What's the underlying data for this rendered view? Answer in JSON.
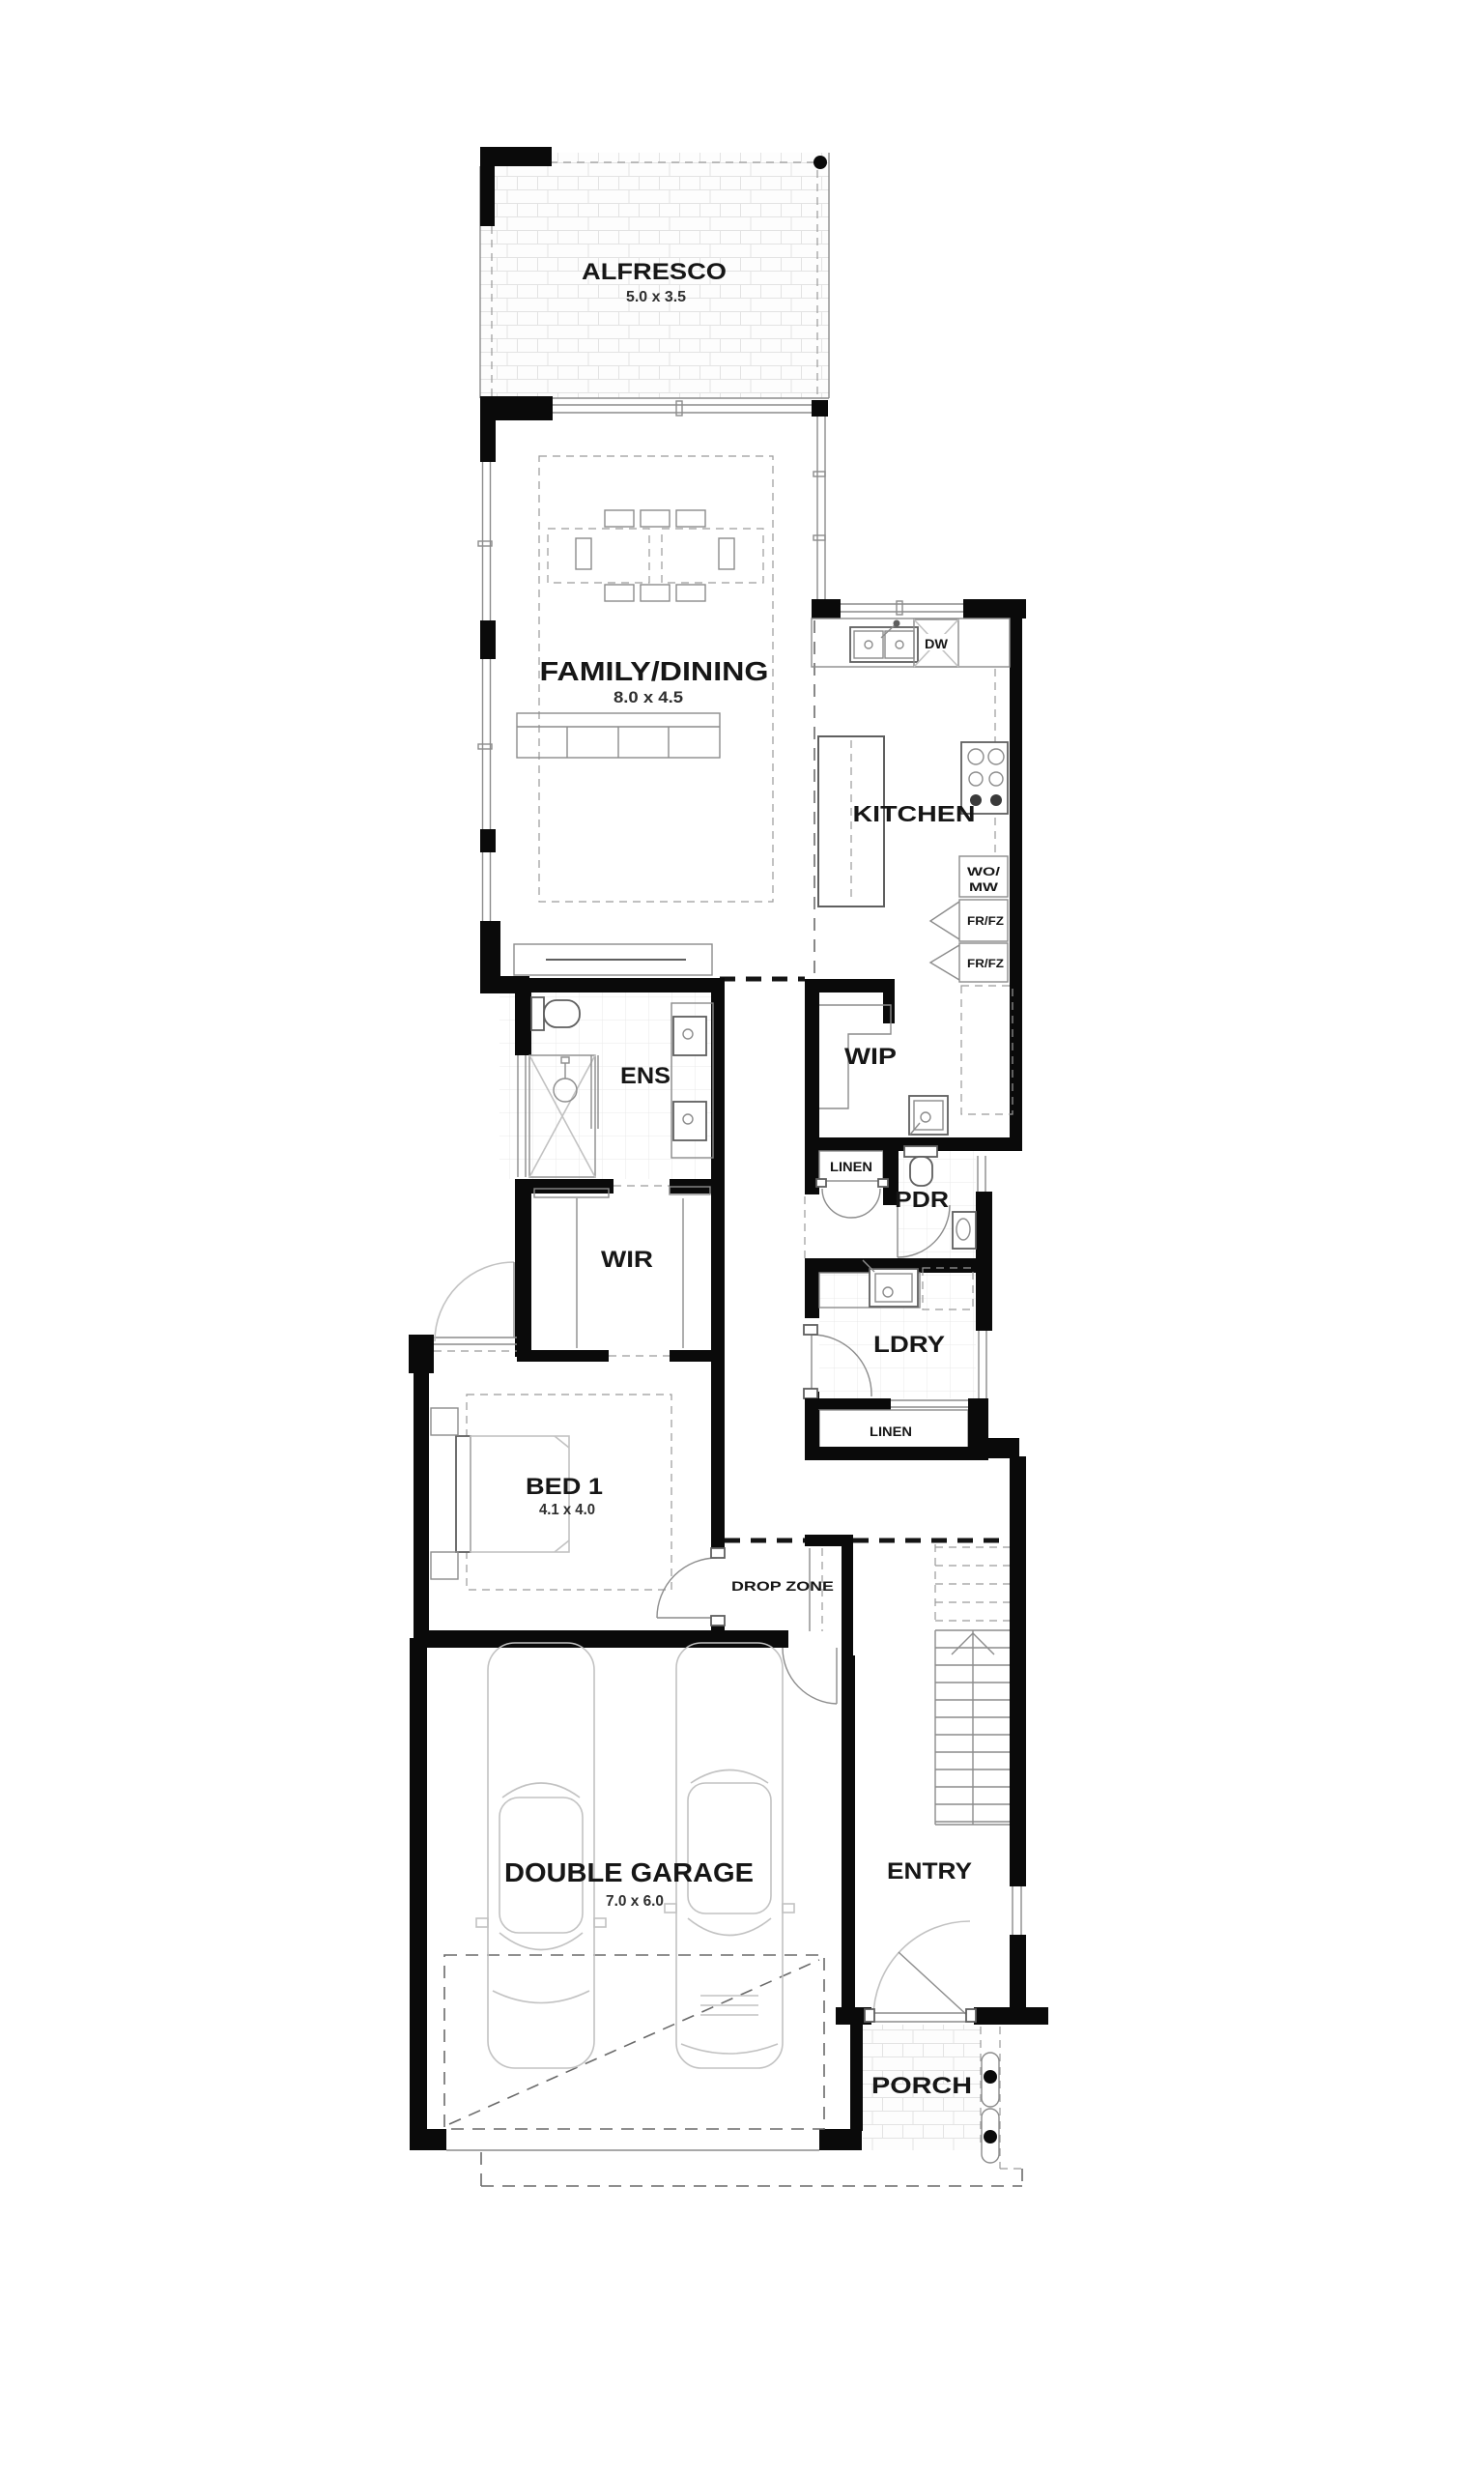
{
  "document": {
    "type": "single-storey house floor plan",
    "style": "black and white architectural drawing"
  },
  "colors": {
    "wall": "#0a0a0a",
    "line": "#5f5f5f",
    "light_line": "#c2c2c2",
    "text": "#161616",
    "background": "#ffffff"
  },
  "rooms": {
    "alfresco": {
      "label": "ALFRESCO",
      "dims": "5.0 x 3.5"
    },
    "family_dining": {
      "label": "FAMILY/DINING",
      "dims": "8.0 x 4.5"
    },
    "kitchen": {
      "label": "KITCHEN"
    },
    "ens": {
      "label": "ENS"
    },
    "wip": {
      "label": "WIP"
    },
    "pdr": {
      "label": "PDR"
    },
    "wir": {
      "label": "WIR"
    },
    "ldry": {
      "label": "LDRY"
    },
    "bed1": {
      "label": "BED 1",
      "dims": "4.1 x 4.0"
    },
    "drop_zone": {
      "label": "DROP ZONE"
    },
    "garage": {
      "label": "DOUBLE GARAGE",
      "dims": "7.0 x 6.0"
    },
    "entry": {
      "label": "ENTRY"
    },
    "porch": {
      "label": "PORCH"
    }
  },
  "annotations": {
    "dishwasher": "DW",
    "wall_oven_microwave_line1": "WO/",
    "wall_oven_microwave_line2": "MW",
    "fridge_freezer_1": "FR/FZ",
    "fridge_freezer_2": "FR/FZ",
    "linen_hall": "LINEN",
    "linen_laundry": "LINEN"
  }
}
